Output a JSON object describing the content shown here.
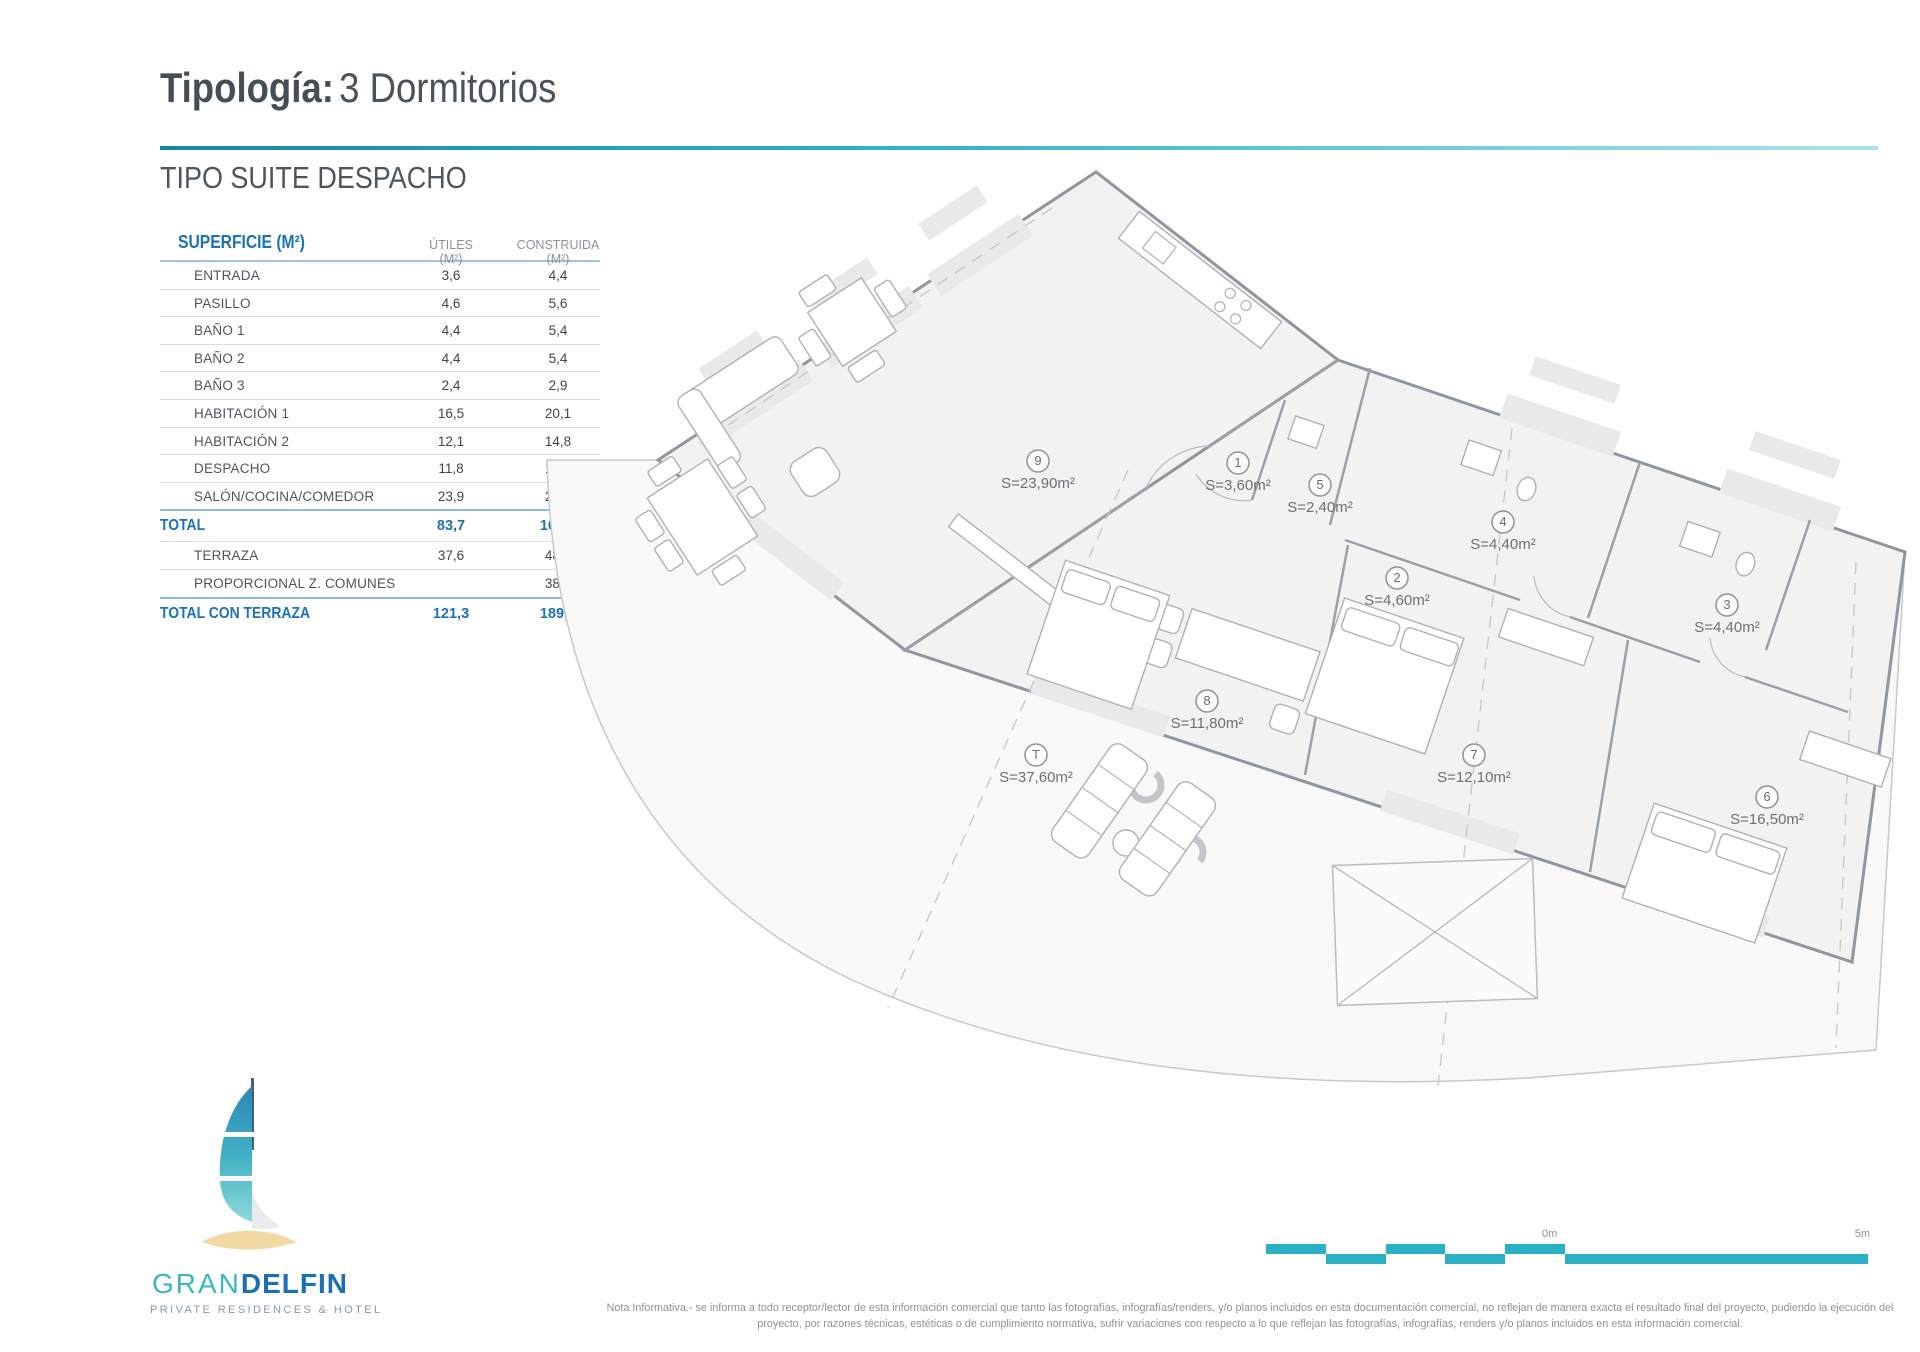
{
  "header": {
    "title_label": "Tipología:",
    "title_value": "3 Dormitorios",
    "subtitle": "TIPO SUITE DESPACHO"
  },
  "table": {
    "col_room": "SUPERFICIE (M²)",
    "col_utiles": "ÚTILES (M²)",
    "col_construida": "CONSTRUIDA (M²)",
    "rows": [
      {
        "label": "ENTRADA",
        "utiles": "3,6",
        "construida": "4,4"
      },
      {
        "label": "PASILLO",
        "utiles": "4,6",
        "construida": "5,6"
      },
      {
        "label": "BAÑO 1",
        "utiles": "4,4",
        "construida": "5,4"
      },
      {
        "label": "BAÑO 2",
        "utiles": "4,4",
        "construida": "5,4"
      },
      {
        "label": "BAÑO 3",
        "utiles": "2,4",
        "construida": "2,9"
      },
      {
        "label": "HABITACIÓN 1",
        "utiles": "16,5",
        "construida": "20,1"
      },
      {
        "label": "HABITACIÓN 2",
        "utiles": "12,1",
        "construida": "14,8"
      },
      {
        "label": "DESPACHO",
        "utiles": "11,8",
        "construida": "14,4"
      },
      {
        "label": "SALÓN/COCINA/COMEDOR",
        "utiles": "23,9",
        "construida": "29,2"
      }
    ],
    "total": {
      "label": "TOTAL",
      "utiles": "83,7",
      "construida": "102,1"
    },
    "extra_rows": [
      {
        "label": "TERRAZA",
        "utiles": "37,6",
        "construida": "48,8"
      },
      {
        "label": "PROPORCIONAL Z. COMUNES",
        "utiles": "",
        "construida": "38,8"
      }
    ],
    "total_terraza": {
      "label": "TOTAL CON TERRAZA",
      "utiles": "121,3",
      "construida": "189,7"
    }
  },
  "plan": {
    "rooms": [
      {
        "number": "9",
        "area": "S=23,90m²"
      },
      {
        "number": "1",
        "area": "S=3,60m²"
      },
      {
        "number": "5",
        "area": "S=2,40m²"
      },
      {
        "number": "2",
        "area": "S=4,60m²"
      },
      {
        "number": "4",
        "area": "S=4,40m²"
      },
      {
        "number": "3",
        "area": "S=4,40m²"
      },
      {
        "number": "8",
        "area": "S=11,80m²"
      },
      {
        "number": "7",
        "area": "S=12,10m²"
      },
      {
        "number": "6",
        "area": "S=16,50m²"
      },
      {
        "number": "T",
        "area": "S=37,60m²"
      }
    ]
  },
  "scalebar": {
    "zero_label": "0m",
    "five_label": "5m"
  },
  "logo": {
    "brand_first": "GRAN",
    "brand_second": "DELFIN",
    "tagline": "PRIVATE RESIDENCES & HOTEL"
  },
  "footer": {
    "note": "Nota Informativa.- se informa a todo receptor/lector de esta información comercial que tanto las fotografías, infografías/renders, y/o planos incluidos en esta documentación comercial, no reflejan de manera exacta el resultado final del proyecto, pudiendo la ejecución del proyecto, por razones técnicas, estéticas o de cumplimiento normativa, sufrir variaciones con respecto a lo que reflejan las fotografías, infografías, renders y/o planos incluidos en esta información comercial."
  },
  "colors": {
    "accent_teal": "#2ab1c5",
    "accent_blue": "#1d71b8"
  }
}
